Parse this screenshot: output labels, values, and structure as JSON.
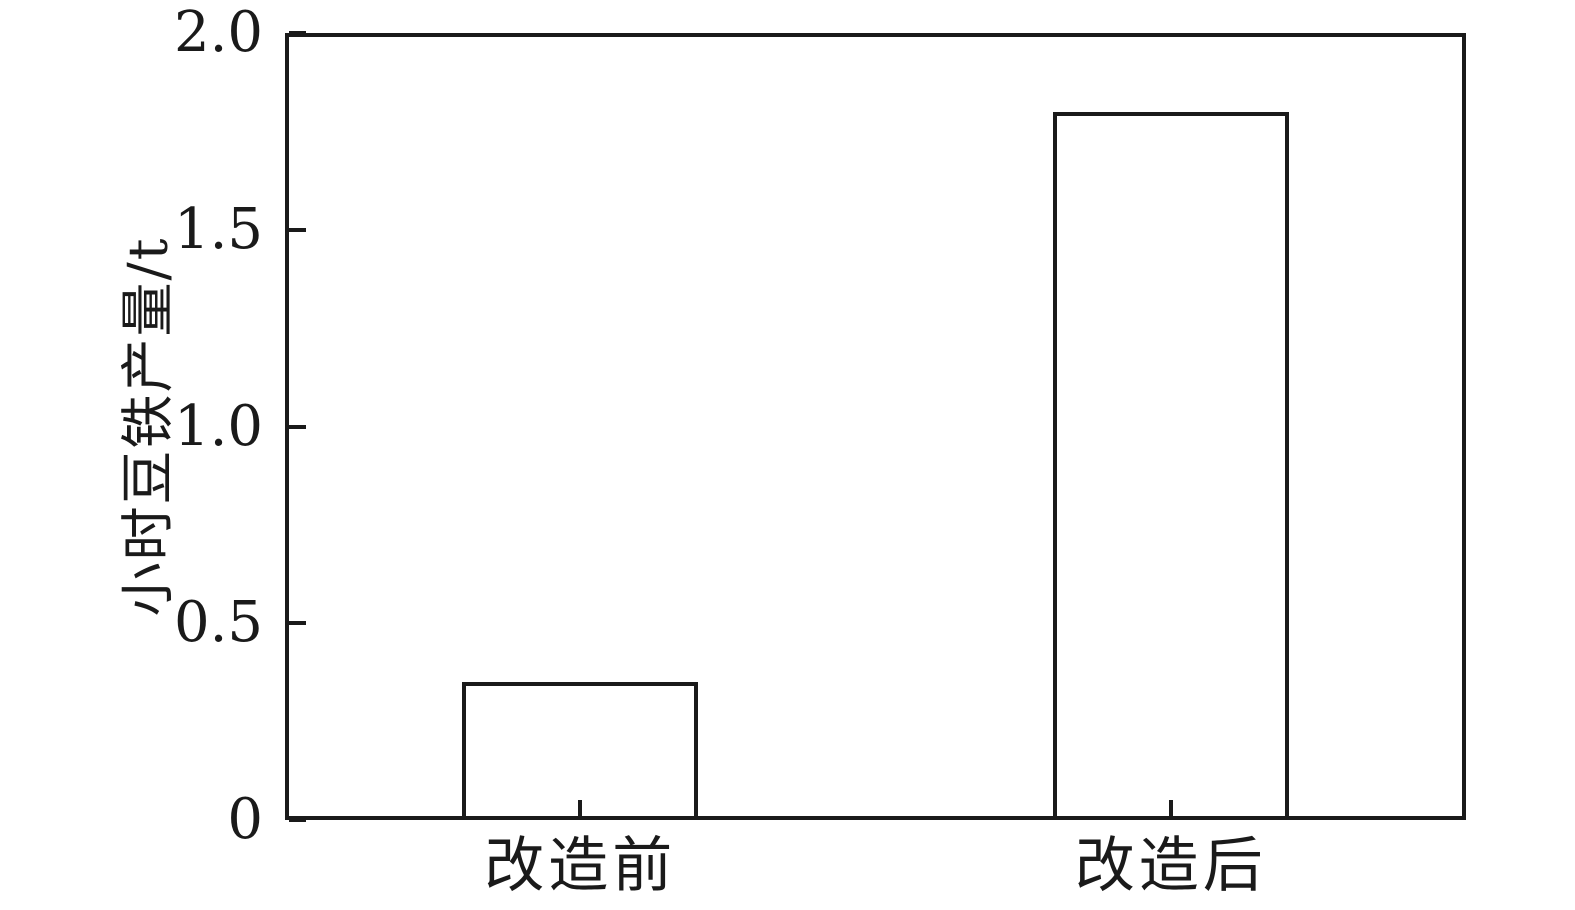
{
  "figure": {
    "background": "#ffffff",
    "line_color": "#1a1a1a"
  },
  "chart_data": {
    "type": "bar",
    "categories": [
      "改造前",
      "改造后"
    ],
    "values": [
      0.35,
      1.8
    ],
    "title": "",
    "xlabel": "",
    "ylabel": "小时豆铁产量/t",
    "ylim": [
      0,
      2.0
    ],
    "yticks": [
      0,
      0.5,
      1.0,
      1.5,
      2.0
    ],
    "ytick_labels": [
      "0",
      "0.5",
      "1.0",
      "1.5",
      "2.0"
    ],
    "bar_fill": "#ffffff",
    "bar_edge": "#1a1a1a",
    "grid": false,
    "legend": null,
    "tick_direction": "in"
  }
}
